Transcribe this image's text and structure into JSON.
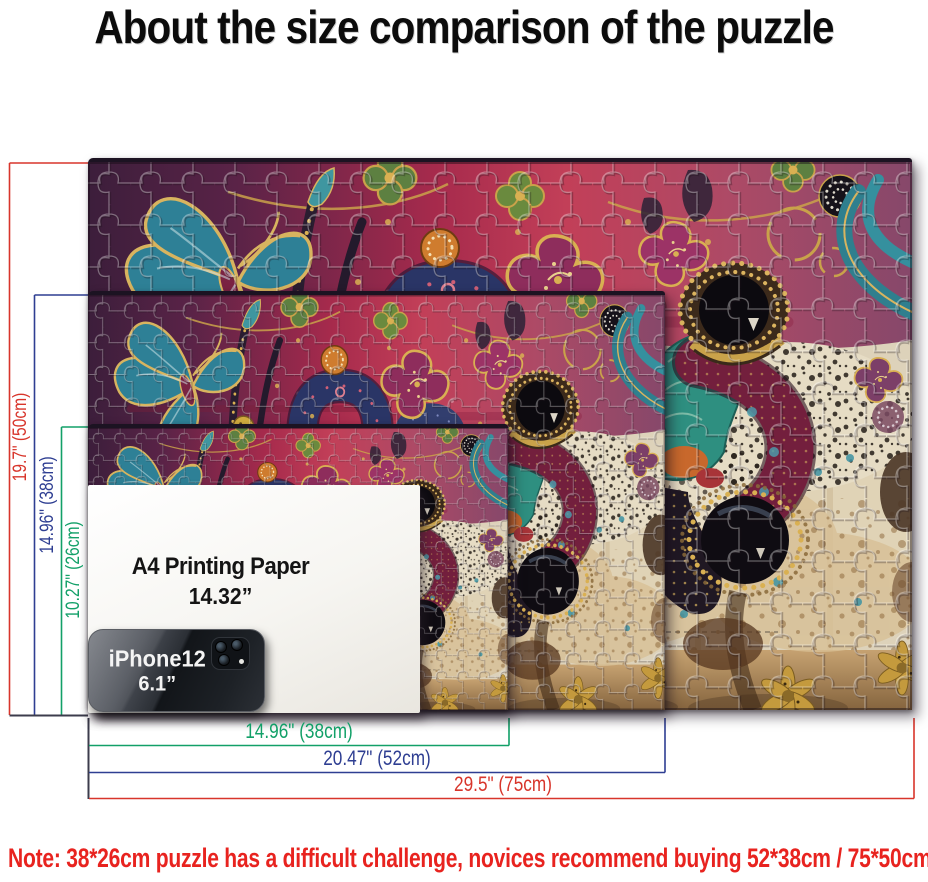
{
  "title": "About the size comparison of the puzzle",
  "note": "Note:  38*26cm puzzle has a difficult challenge, novices recommend buying 52*38cm / 75*50cm",
  "labels": {
    "h50": "19.7\"  (50cm)",
    "h38": "14.96\"  (38cm)",
    "h26": "10.27\"  (26cm)",
    "w38": "14.96\"  (38cm)",
    "w52": "20.47\"  (52cm)",
    "w75": "29.5\"  (75cm)"
  },
  "a4_paper": {
    "line1": "A4 Printing Paper",
    "line2": "14.32”"
  },
  "iphone": {
    "line1": "iPhone12",
    "line2": "6.1”"
  },
  "puzzle_sizes": [
    "75*50cm",
    "52*38cm",
    "38*26cm"
  ],
  "colors": {
    "dim_red": "#d8352b",
    "dim_blue": "#2e3e92",
    "dim_green": "#12a068",
    "note_red": "#e8231f",
    "title_black": "#0c0c0c"
  }
}
